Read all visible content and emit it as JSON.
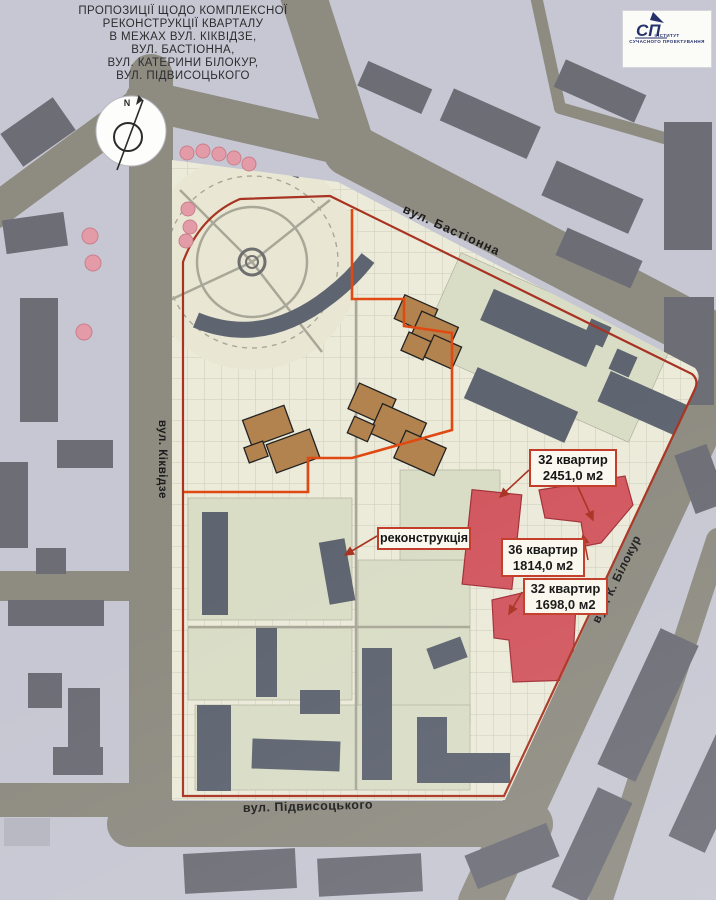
{
  "palette": {
    "bg": "#c6c7d2",
    "street": "#8e8b81",
    "site": "#ecead9",
    "park": "#e9e7d4",
    "green": "#d9ddc6",
    "bld_out": "#6d6d76",
    "bld_in": "#5e6470",
    "brown": "#b2834f",
    "red_bld": "#d2575f",
    "bound": "#a93322",
    "orange": "#e04a12",
    "pink": "#e39ca7",
    "box_bg": "#faf8ee",
    "box_border": "#c23b28",
    "navy": "#25316b",
    "ink": "#1c1c1c"
  },
  "title": {
    "lines": [
      "ПРОПОЗИЦІЇ ЩОДО КОМПЛЕКСНОЇ",
      "РЕКОНСТРУКЦІЇ КВАРТАЛУ",
      "В МЕЖАХ ВУЛ. КІКВІДЗЕ,",
      "ВУЛ. БАСТІОННА,",
      "ВУЛ. КАТЕРИНИ БІЛОКУР,",
      "ВУЛ. ПІДВИСОЦЬКОГО"
    ]
  },
  "logo": {
    "monogram": "СП",
    "line1": "ІНСТИТУТ",
    "line2": "СУЧАСНОГО ПРОЕКТУВАННЯ"
  },
  "compass": {
    "north": "N"
  },
  "streets": {
    "bastionna": "вул. Бастіонна",
    "kikvidze": "вул. Кіквідзе",
    "bilokur": "вул. К. Білокур",
    "pidvysotskoho": "вул. Підвисоцького"
  },
  "annotations": {
    "block1": {
      "line1": "32 квартир",
      "line2": "2451,0 м2"
    },
    "block2": {
      "line1": "36 квартир",
      "line2": "1814,0 м2"
    },
    "block3": {
      "line1": "32 квартир",
      "line2": "1698,0 м2"
    },
    "reconstruction": "реконструкція"
  }
}
